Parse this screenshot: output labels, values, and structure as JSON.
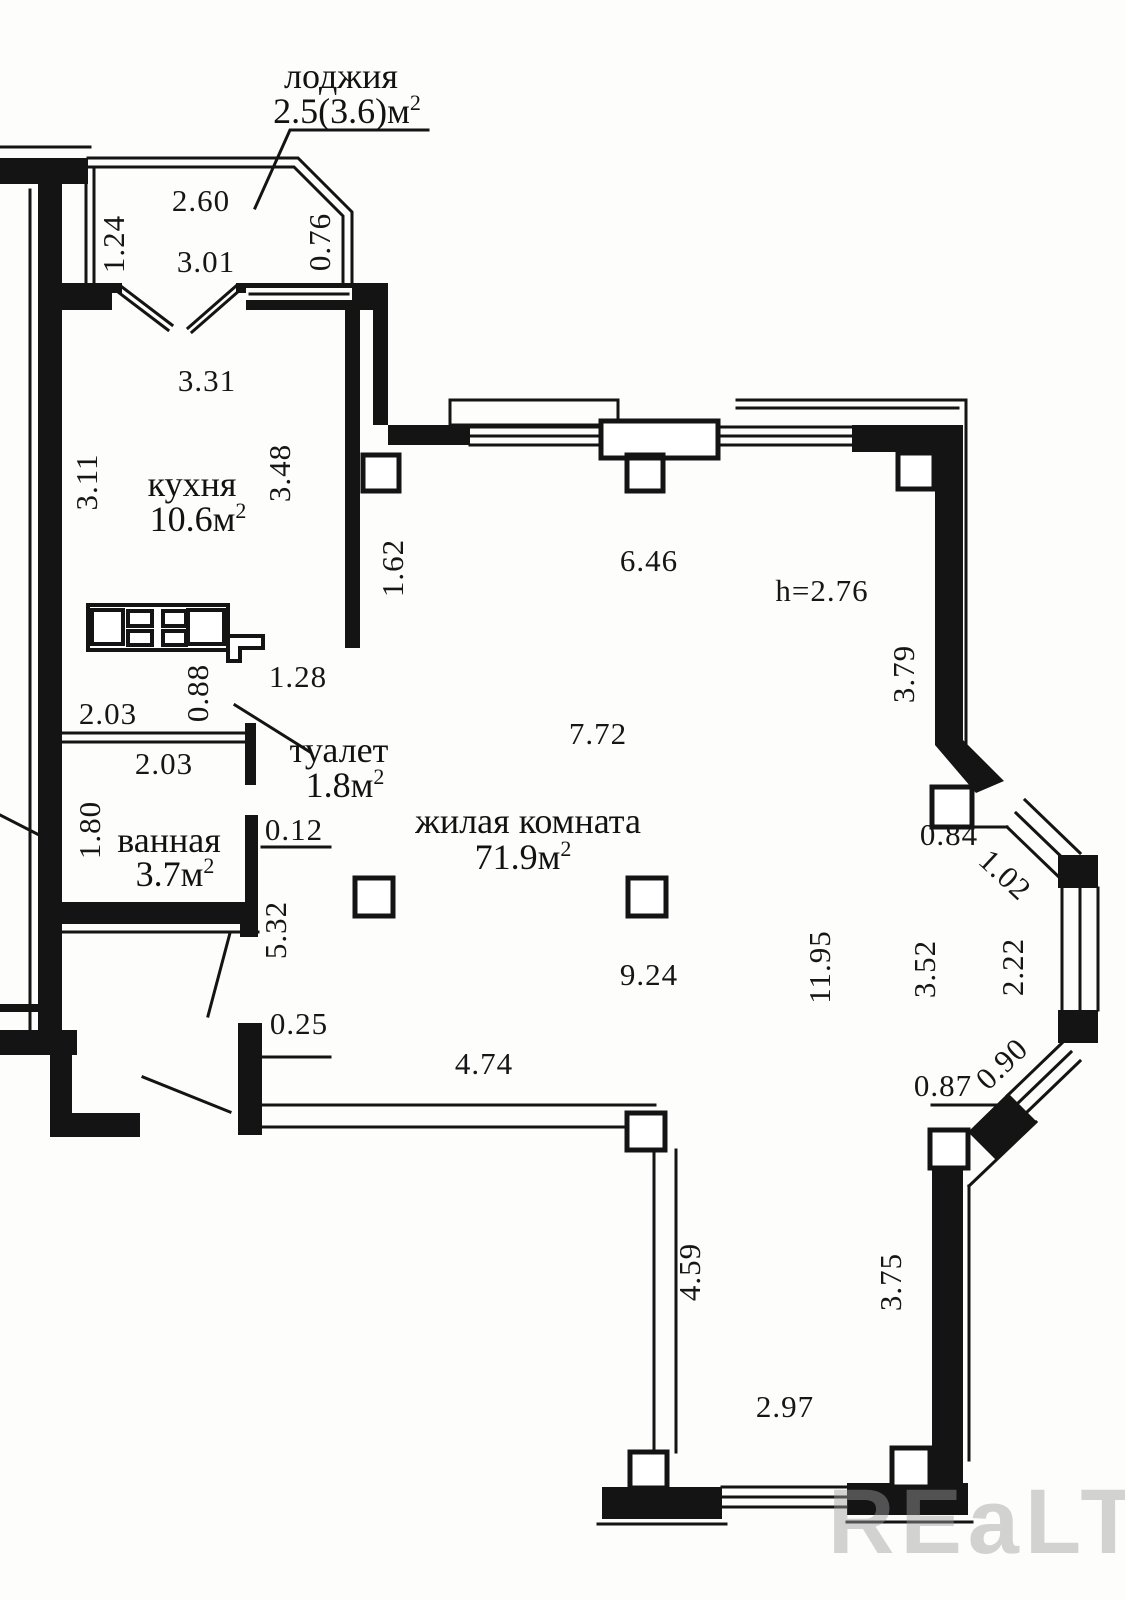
{
  "plan": {
    "watermark": "REaLT",
    "height_note": "h=2.76",
    "rooms": {
      "loggia": {
        "name": "лоджия",
        "area": "2.5(3.6)м",
        "sup": "2"
      },
      "kitchen": {
        "name": "кухня",
        "area": "10.6м",
        "sup": "2"
      },
      "toilet": {
        "name": "туалет",
        "area": "1.8м",
        "sup": "2"
      },
      "bathroom": {
        "name": "ванная",
        "area": "3.7м",
        "sup": "2"
      },
      "living": {
        "name": "жилая комната",
        "area": "71.9м",
        "sup": "2"
      }
    },
    "dims": {
      "loggia_width": "2.60",
      "loggia_left": "1.24",
      "loggia_bottom": "3.01",
      "loggia_side": "0.76",
      "kitchen_width": "3.31",
      "kitchen_left": "3.11",
      "kitchen_depth": "3.48",
      "wall_162": "1.62",
      "living_top_width": "6.46",
      "toilet_depth": "0.88",
      "passage_128": "1.28",
      "toilet_width": "2.03",
      "bath_width": "2.03",
      "bath_depth": "1.80",
      "jamb_012": "0.12",
      "living_mid_width": "7.72",
      "hall_length": "5.32",
      "right_wall_upper": "3.79",
      "bay_top": "0.84",
      "bay_diag_upper": "1.02",
      "living_height": "11.95",
      "living_right_height": "3.52",
      "bay_vertical": "2.22",
      "living_lower_width": "9.24",
      "bay_diag_lower": "0.90",
      "bay_bottom": "0.87",
      "entry_jamb": "0.25",
      "living_bottom_width": "4.74",
      "living_left_lower": "4.59",
      "right_wall_lower": "3.75",
      "bottom_width": "2.97"
    }
  }
}
